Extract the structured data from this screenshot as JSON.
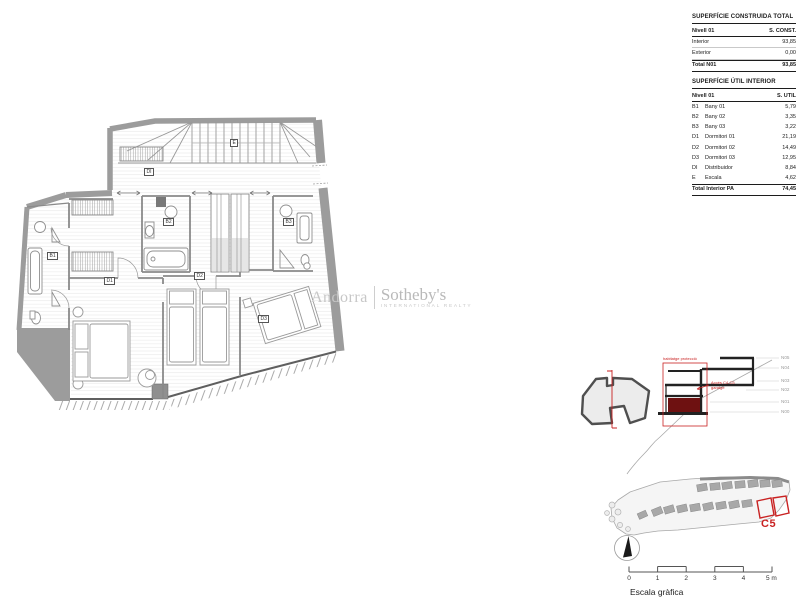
{
  "tables": {
    "construida": {
      "title": "SUPERFÍCIE CONSTRUIDA TOTAL",
      "col1": "Nivell 01",
      "col2": "S. CONST.",
      "rows": [
        {
          "name": "Interior",
          "value": "93,85"
        },
        {
          "name": "Exterior",
          "value": "0,00"
        }
      ],
      "total_name": "Total N01",
      "total_value": "93,85"
    },
    "util": {
      "title": "SUPERFÍCIE ÚTIL INTERIOR",
      "col1": "Nivell 01",
      "col2": "S. UTIL",
      "rows": [
        {
          "code": "B1",
          "name": "Bany 01",
          "value": "5,79"
        },
        {
          "code": "B2",
          "name": "Bany 02",
          "value": "3,35"
        },
        {
          "code": "B3",
          "name": "Bany 03",
          "value": "3,22"
        },
        {
          "code": "D1",
          "name": "Dormitori 01",
          "value": "21,19"
        },
        {
          "code": "D2",
          "name": "Dormitori 02",
          "value": "14,49"
        },
        {
          "code": "D3",
          "name": "Dormitori 03",
          "value": "12,95"
        },
        {
          "code": "DI",
          "name": "Distribuidor",
          "value": "8,84"
        },
        {
          "code": "E",
          "name": "Escala",
          "value": "4,62"
        }
      ],
      "total_name": "Total Interior PA",
      "total_value": "74,45"
    }
  },
  "watermark": {
    "brand": "Andorra",
    "name": "Sotheby's",
    "subtitle": "INTERNATIONAL REALTY"
  },
  "plan": {
    "labels": [
      "E",
      "DI",
      "B1",
      "B2",
      "B3",
      "D1",
      "D2",
      "D3"
    ]
  },
  "section": {
    "levels": [
      "N05",
      "N04",
      "N03",
      "N02",
      "N01",
      "N00"
    ],
    "title": "habitatge protecció",
    "note_line1": "Accés C4-C5",
    "note_line2": "garatge"
  },
  "siteplan": {
    "unit": "C5"
  },
  "scalebar": {
    "ticks": [
      "0",
      "1",
      "2",
      "3",
      "4",
      "5 m"
    ],
    "caption": "Escala gràfica"
  },
  "colors": {
    "accent_red": "#c92222",
    "maroon": "#6e1111",
    "wall_gray": "#9c9c9c",
    "watermark_gray": "#bfbfbf"
  }
}
